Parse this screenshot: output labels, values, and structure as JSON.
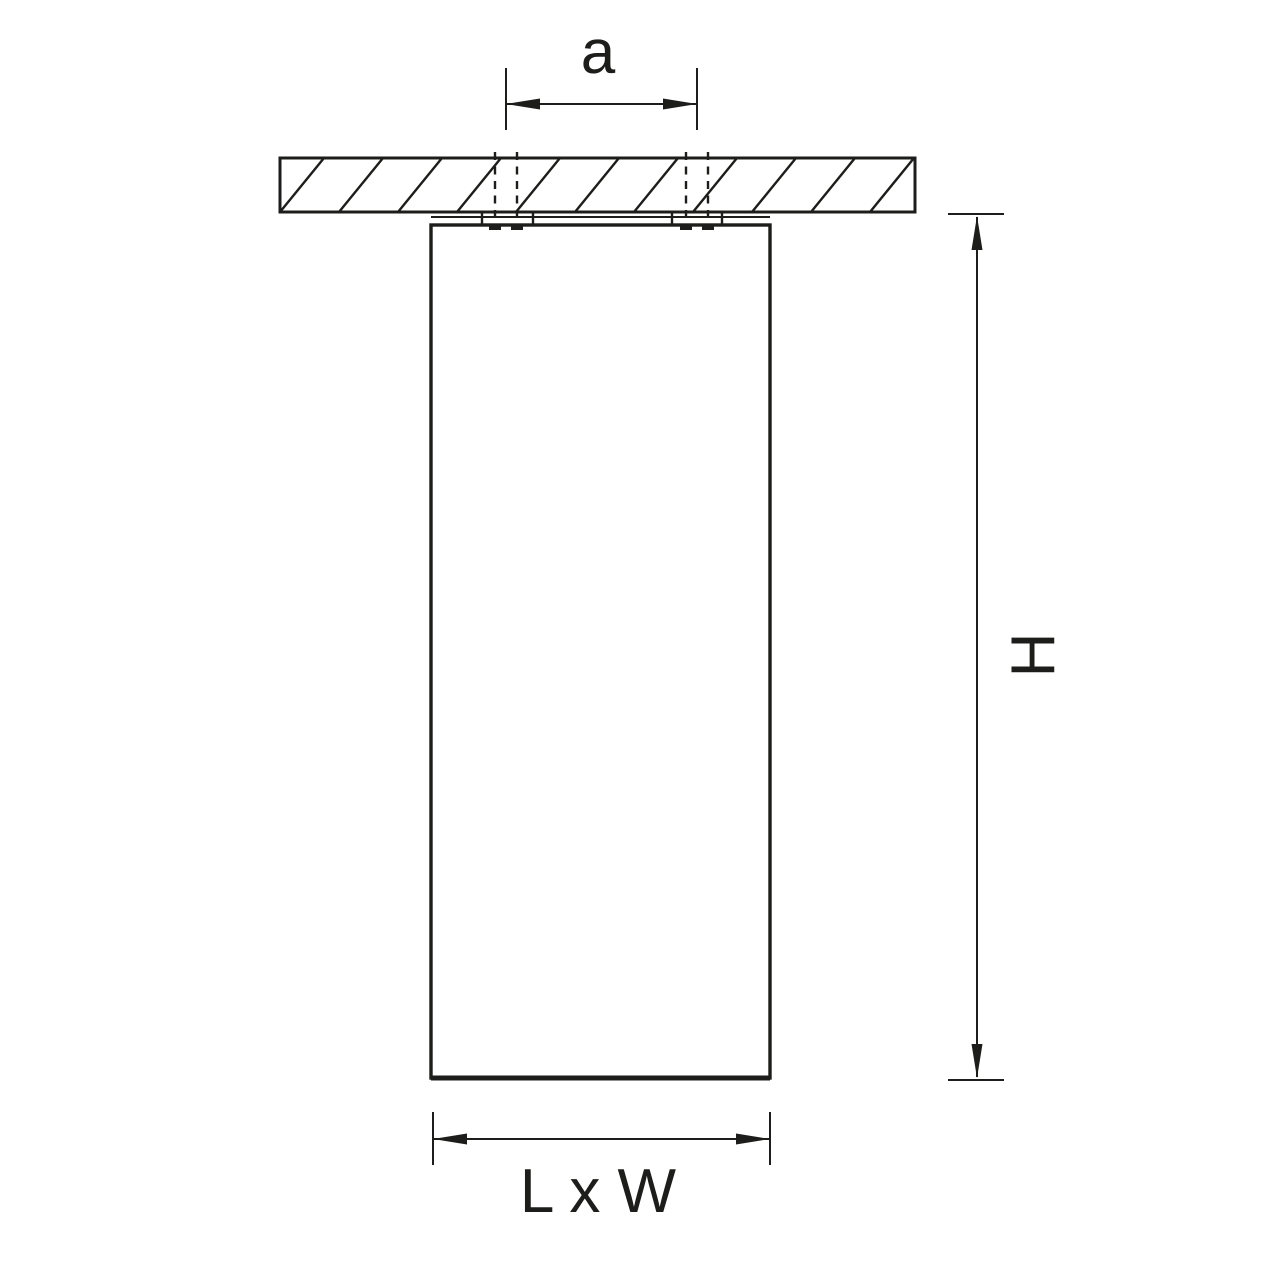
{
  "diagram": {
    "labels": {
      "spacing": "a",
      "height": "H",
      "base": "L x W"
    },
    "colors": {
      "line": "#1d1d1b",
      "background": "#ffffff"
    }
  }
}
